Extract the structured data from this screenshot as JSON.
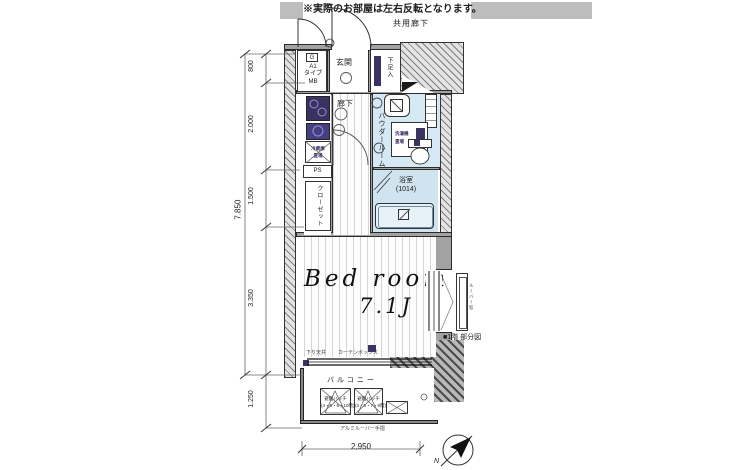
{
  "note": "※実際のお部屋は左右反転となります。",
  "plan": {
    "corridor": "共用廊下",
    "meter": {
      "g": "G",
      "a1": "A1",
      "type": "タイプ",
      "mb": "MB"
    },
    "entrance": "玄関",
    "shoe_box": "下足入",
    "hallway": "廊下",
    "fridge": {
      "l1": "冷蔵庫",
      "l2": "置場"
    },
    "ps": "PS",
    "closet": "クローゼット",
    "powder_room": "パウダールーム",
    "washer": {
      "l1": "洗濯機",
      "l2": "置場"
    },
    "bath": "浴室",
    "bath_size": "(1014)",
    "bedroom": {
      "name": "Bed room",
      "size": "7.1J"
    },
    "ceiling_note": "下り天井",
    "curtain_box": "カーテンボックス",
    "balcony": "バルコニー",
    "hatch": {
      "title": "避難ハッチ",
      "left_floors": "(4・6・8・10階)",
      "right_floors": "(3・5・7・9階)"
    },
    "handrail": "アルミルーバー手摺",
    "partial_plan": "■1階 部分図",
    "louver_window": "ルーバー窓",
    "compass_n": "N"
  },
  "dimensions": {
    "overall_height": "7.850",
    "seg_entry": "800",
    "seg_kitchen": "2.000",
    "seg_bath": "1.500",
    "seg_bedroom": "3.350",
    "seg_balcony": "1.250",
    "width": "2,950"
  },
  "colors": {
    "room_blue": "#d4e9f3",
    "fixture_purple": "#3a3465",
    "wall_gray": "#a2a2a2"
  }
}
